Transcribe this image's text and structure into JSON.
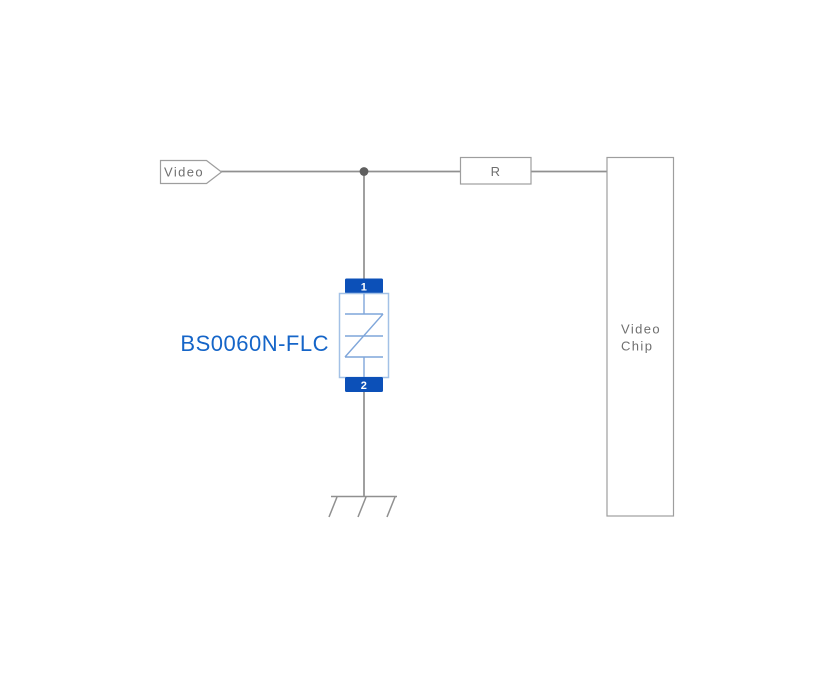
{
  "diagram": {
    "video_net": {
      "label": "Video"
    },
    "resistor": {
      "label": "R"
    },
    "chip": {
      "label_line1": "Video",
      "label_line2": "Chip"
    },
    "protection_device": {
      "part_number": "BS0060N-FLC",
      "pin_top": "1",
      "pin_bottom": "2"
    }
  },
  "colors": {
    "wire": "#909090",
    "outline": "#9e9e9e",
    "text_gray": "#6f6f6f",
    "junction": "#5f5f5f",
    "device_blue": "#0c50b8",
    "device_body_blue": "#a3c1e6",
    "device_symbol_blue": "#7fa6da",
    "label_blue": "#1565c8"
  }
}
